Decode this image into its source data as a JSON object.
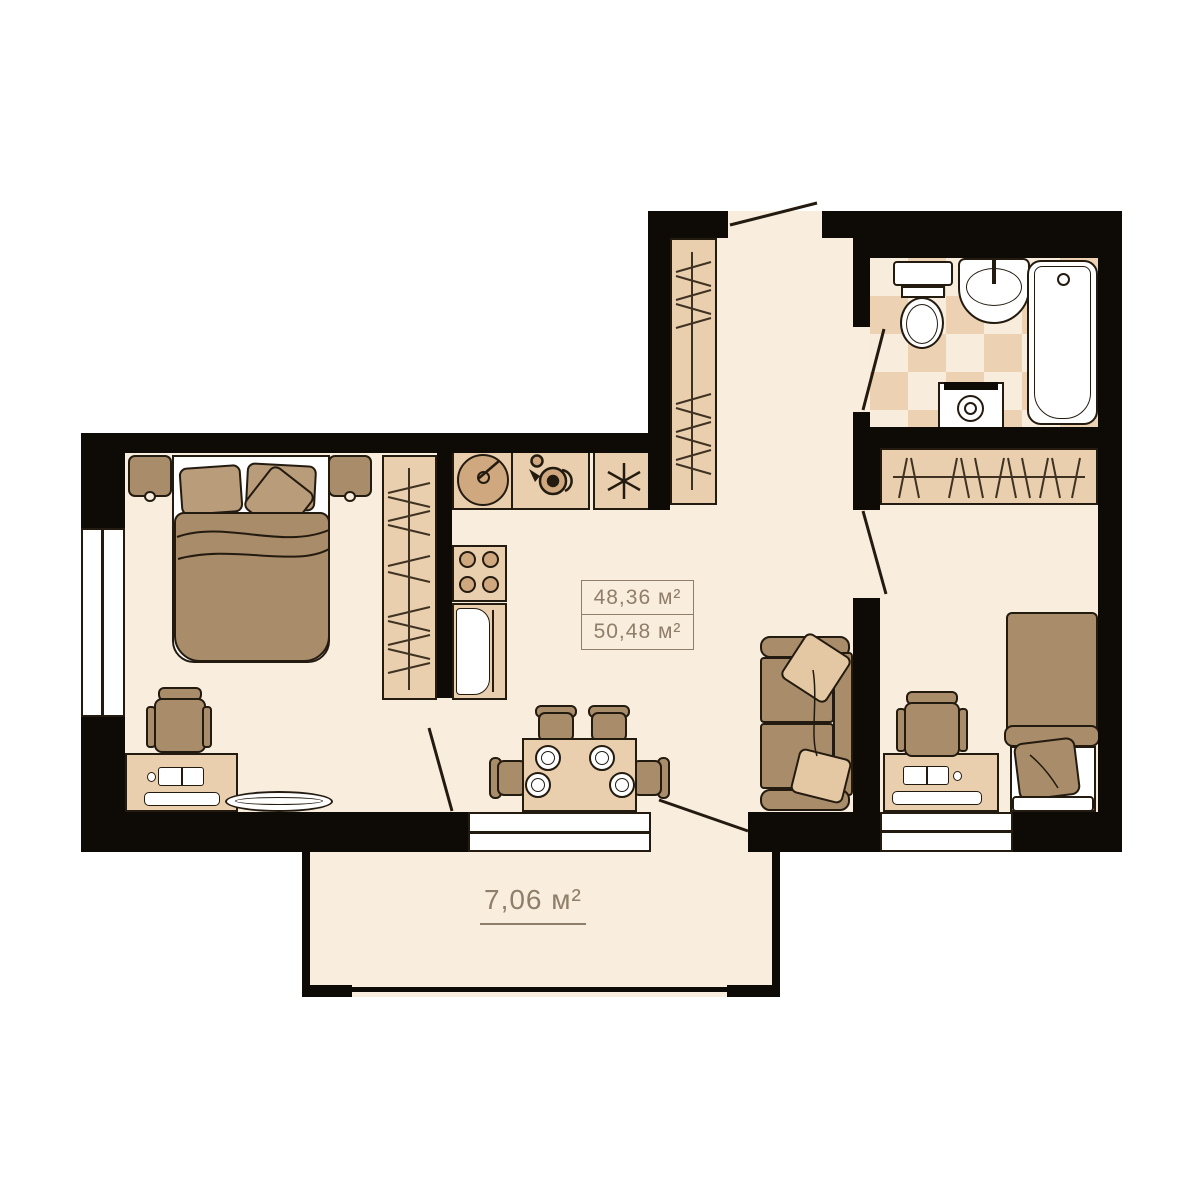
{
  "labels": {
    "room_area_line1": "48,36 м²",
    "room_area_line2": "50,48 м²",
    "balcony_area": "7,06 м²"
  },
  "colors": {
    "canvas": "#ffffff",
    "wall": "#0e0b07",
    "floor": "#f9edde",
    "tile": "#ecd2b2",
    "tan": "#e9cfae",
    "tan_dark": "#cfa87f",
    "brown": "#a98c6a",
    "brown_light": "#b99c7a",
    "pillow_light": "#e4c8a4",
    "outline": "#241b10",
    "label": "#8f7e69",
    "white": "#ffffff"
  }
}
